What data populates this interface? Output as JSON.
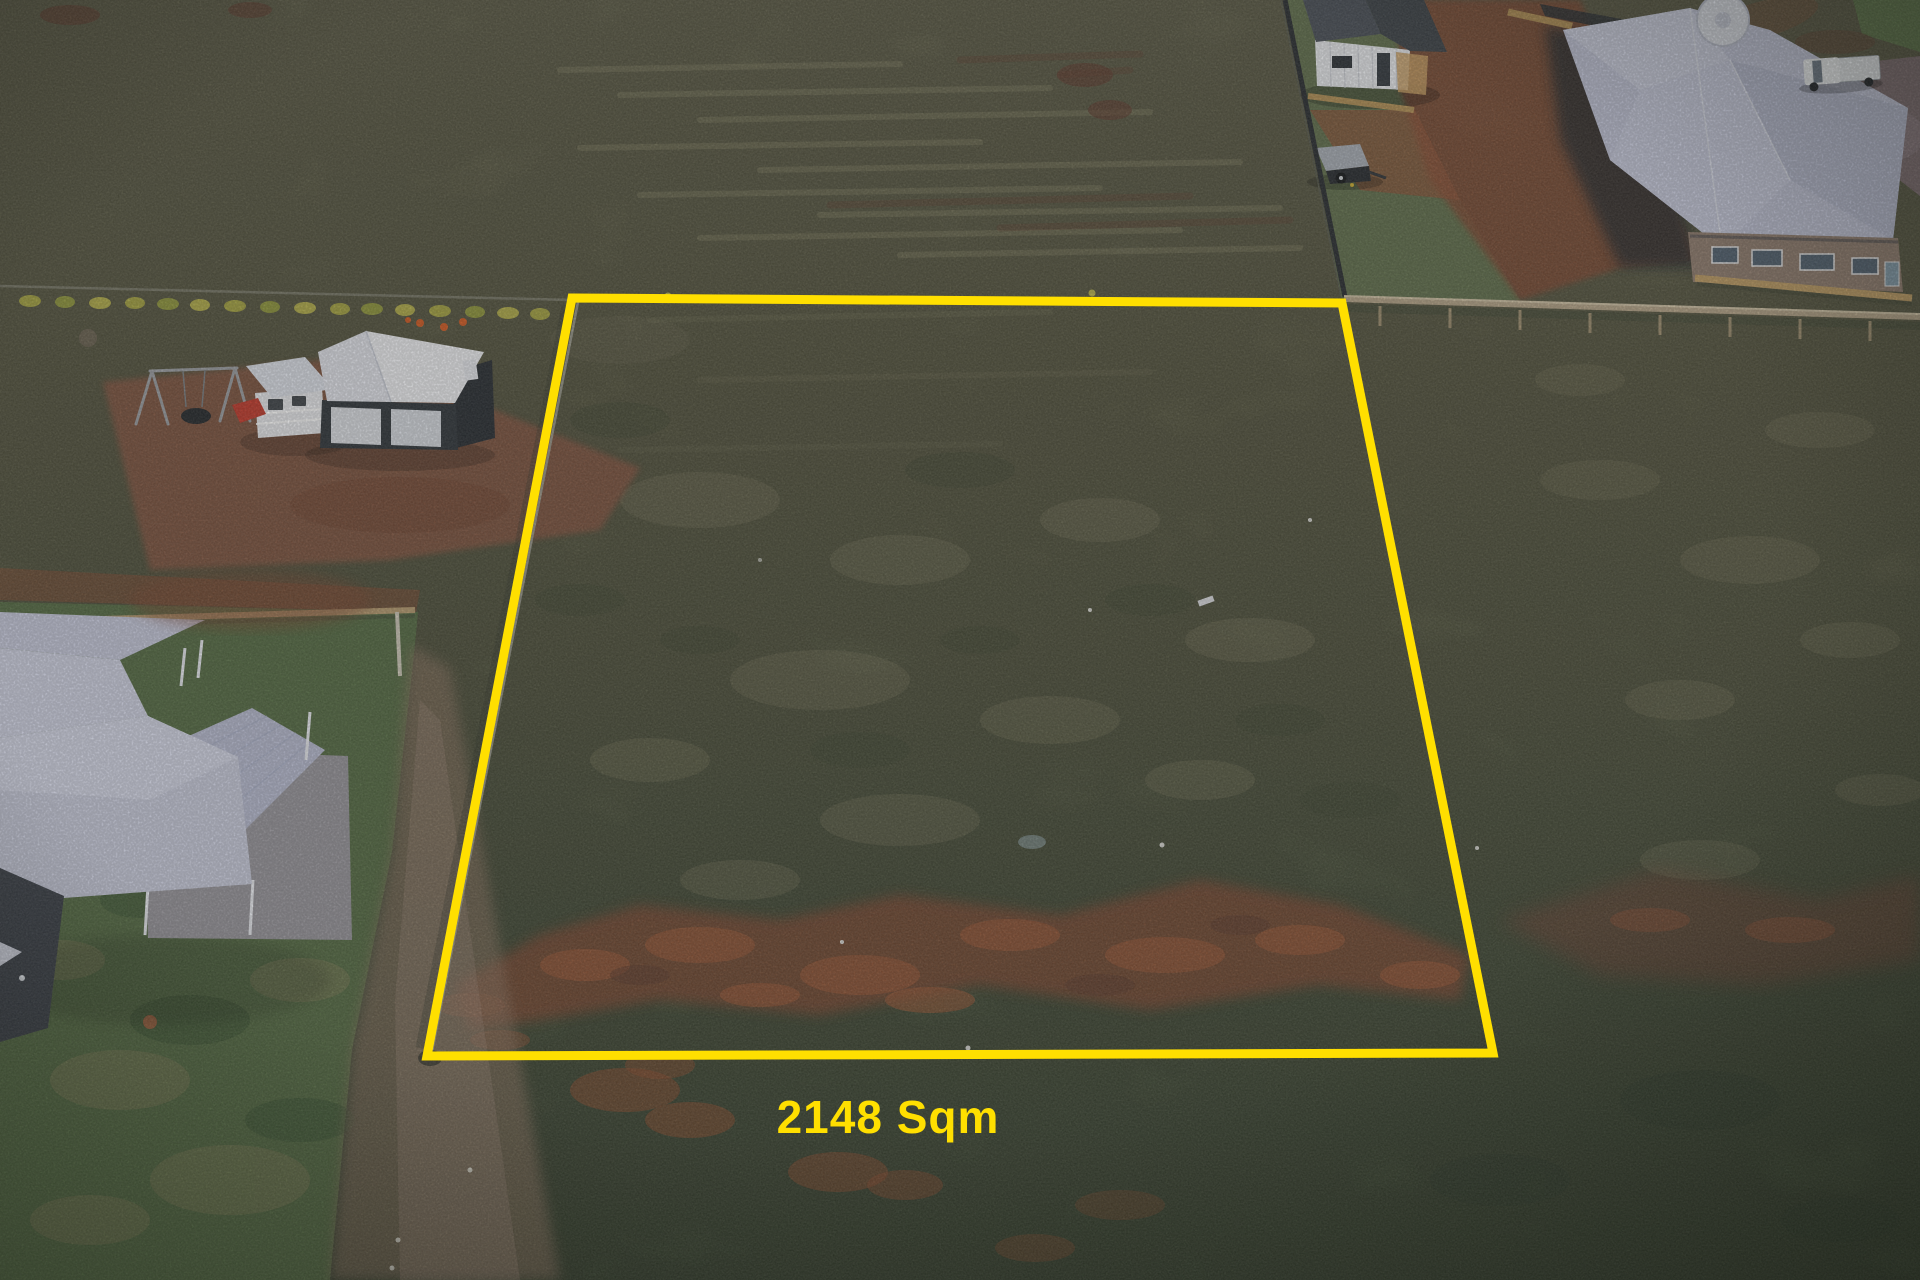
{
  "scene": {
    "type": "aerial-drone-photograph",
    "description": "Aerial drone view of a vacant residential block outlined in yellow, surrounded by neighbouring houses, sheds, playground and paddocks with red dirt patches",
    "area_label": {
      "text": "2148 Sqm",
      "color": "#ffdf00"
    },
    "lot_outline": {
      "color": "#ffdf00",
      "stroke_width": 9,
      "corners": [
        [
          572,
          298
        ],
        [
          1342,
          303
        ],
        [
          1493,
          1053
        ],
        [
          427,
          1056
        ]
      ]
    },
    "landmarks": [
      "vacant-lot",
      "swing-set",
      "cubby-house-with-red-slide",
      "black-garage-with-white-roof",
      "white-roof-house-southwest",
      "brick-house-northeast",
      "farm-shed-north",
      "covered-trailer",
      "white-ute",
      "water-tank",
      "timber-paling-fence",
      "wire-fence-with-yellow-shrubs",
      "red-dirt-band",
      "dirt-track"
    ],
    "palette": {
      "field_olive": "#68684e",
      "field_dark": "#3f4c36",
      "lawn_green": "#516840",
      "red_dirt": "#7a452f",
      "track_brown": "#8d7360",
      "roof_light": "#c6c9dc",
      "shed_dark_wall": "#2b3137",
      "paling_fence": "#b3a286",
      "boundary_yellow": "#ffdf00"
    }
  }
}
